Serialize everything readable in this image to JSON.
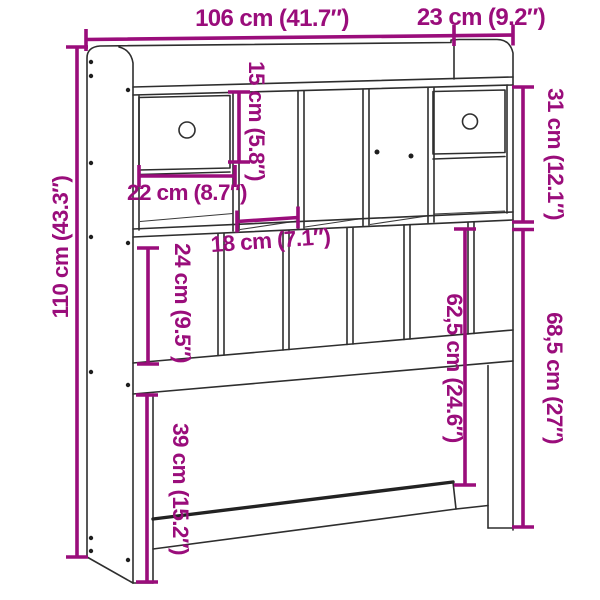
{
  "figure": {
    "title": "Headboard with storage – dimension diagram",
    "accent_color": "#9A0D7B",
    "line_color": "#2e2e2e",
    "background_color": "#ffffff"
  },
  "dimensions": {
    "total_width": {
      "label": "106 cm (41.7″)"
    },
    "depth": {
      "label": "23 cm (9.2″)"
    },
    "total_height": {
      "label": "110 cm (43.3″)"
    },
    "compartment_height": {
      "label": "15 cm (5.8″)"
    },
    "drawer_compartment_width": {
      "label": "22 cm (8.7″)"
    },
    "open_compartment_width": {
      "label": "18 cm (7.1″)"
    },
    "top_section_height": {
      "label": "31 cm (12.1″)"
    },
    "panel_section_height": {
      "label": "24 cm (9.5″)"
    },
    "lower_clearance_height": {
      "label": "39 cm (15.2″)"
    },
    "rail_top_height": {
      "label": "62,5 cm (24.6″)"
    },
    "rail_bottom_height": {
      "label": "68,5 cm (27″)"
    }
  }
}
